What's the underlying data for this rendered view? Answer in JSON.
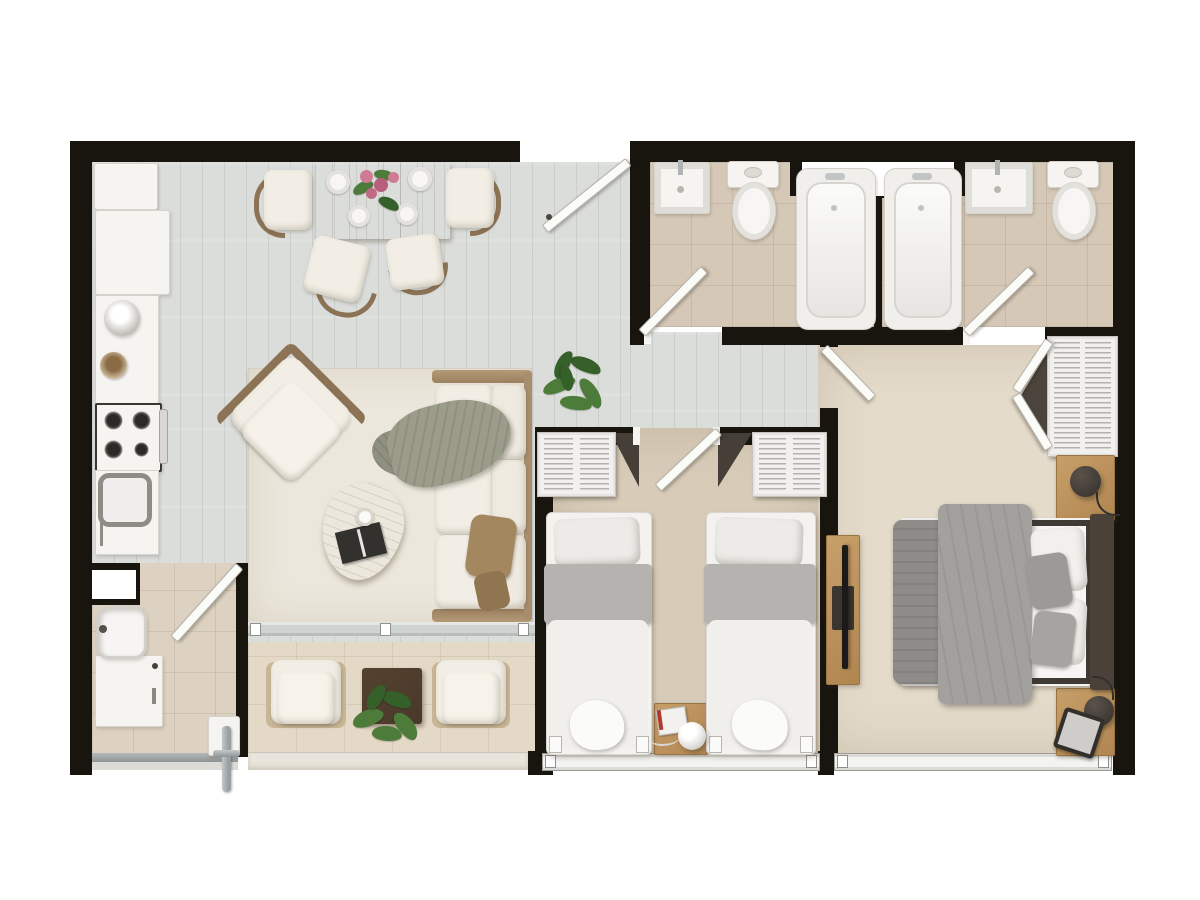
{
  "canvas": {
    "width": 1200,
    "height": 900,
    "type": "apartment-floor-plan-top-view"
  },
  "palette": {
    "outside": "#ffffff",
    "wall": "#18150f",
    "woodFloor": "#dbdddb",
    "bathTile": "#d5c8b6",
    "terraceTile": "#e4d8c6",
    "laundryTile": "#ddd2c1",
    "twinCarpet": "#d8ccb9",
    "masterCarpet": "#e5dbcb",
    "rug": "#ece7dc",
    "fixtureWhite": "#f5f4f1",
    "doorWhite": "#fbfbf8",
    "oak": "#c79f69",
    "woodFrame": "#8d7356",
    "sofaFabric": "#f2eee5",
    "throwSage": "#9c9c8b",
    "pillowBrown": "#a3875f",
    "grayBlanket": "#b5b3b0",
    "grayDuvet": "#a2a19e",
    "darkGrayBlanket": "#8d8c88",
    "headboardBrown": "#4a4239",
    "lampDark": "#332f2a",
    "plantGreen": "#4c7b3a",
    "plantDarkGreen": "#36602a",
    "flowerPink": "#cf7b93",
    "darkTable": "#4a392b",
    "metal": "#9aa0a2"
  },
  "rooms": [
    {
      "name": "kitchen-dining",
      "floor": "light-gray-wood-planks",
      "furniture": [
        "refrigerator",
        "kitchen-cabinet",
        "countertop",
        "kettle",
        "snack-bowl",
        "gas-stove-4-burner",
        "oven-handle",
        "kitchen-sink",
        "dining-table",
        "dining-chair-x4",
        "dinner-plate-x4",
        "flower-centerpiece",
        "entry-door"
      ]
    },
    {
      "name": "living-room",
      "floor": "light-gray-wood-planks",
      "furniture": [
        "area-rug",
        "lounge-armchair",
        "three-seat-sofa",
        "throw-blanket",
        "accent-pillow-x2",
        "teardrop-coffee-table",
        "coffee-cup",
        "magazine",
        "potted-plant",
        "sliding-door-track"
      ]
    },
    {
      "name": "terrace",
      "floor": "beige-tile",
      "furniture": [
        "outdoor-armchair-left",
        "outdoor-side-table",
        "potted-plant",
        "outdoor-armchair-right",
        "parapet-edge"
      ]
    },
    {
      "name": "laundry-room",
      "floor": "beige-tile",
      "furniture": [
        "utility-sink",
        "washing-machine",
        "service-window",
        "door",
        "drain-pipe",
        "bottom-rail"
      ]
    },
    {
      "name": "bathroom-1",
      "floor": "beige-tile",
      "furniture": [
        "wall-sink",
        "toilet",
        "bathtub",
        "door"
      ]
    },
    {
      "name": "bathroom-2",
      "floor": "beige-tile",
      "furniture": [
        "bathtub",
        "wall-sink",
        "toilet",
        "door",
        "shared-window"
      ]
    },
    {
      "name": "hallway",
      "floor": "light-gray-wood-planks",
      "furniture": []
    },
    {
      "name": "twin-bedroom",
      "floor": "beige-carpet",
      "furniture": [
        "wardrobe-left",
        "wardrobe-right",
        "door",
        "single-bed-left",
        "single-bed-right",
        "nightstand",
        "sphere-table-lamp",
        "book",
        "sliding-window"
      ]
    },
    {
      "name": "master-bedroom",
      "floor": "beige-carpet",
      "furniture": [
        "entry-door",
        "wardrobe-bifold",
        "double-bed",
        "headboard",
        "gray-duvet",
        "foot-blanket",
        "pillow-x4",
        "nightstand-top",
        "nightstand-bottom",
        "sphere-lamp-x2",
        "tablet",
        "tv-console",
        "tv",
        "sliding-window"
      ]
    }
  ]
}
